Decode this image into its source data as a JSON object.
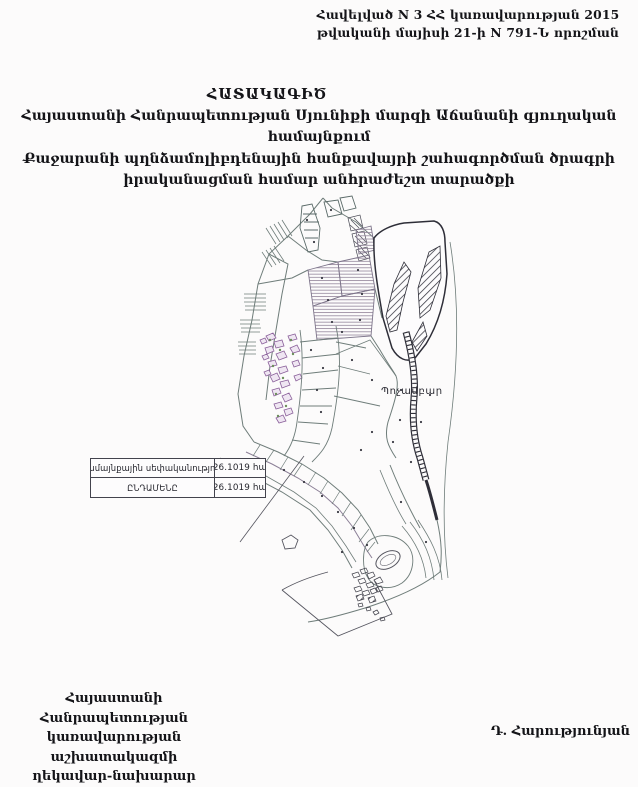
{
  "document": {
    "annex": {
      "line1": "Հավելված N 3",
      "line2": "ՀՀ կառավարության 2015 թվականի",
      "line3": "մայիսի 21-ի N 791-Ն որոշման"
    },
    "title": {
      "line1": "ՀԱՏԱԿԱԳԻԾ",
      "line2": "Հայաստանի Հանրապետության Սյունիքի մարզի Աճանանի գյուղական համայնքում",
      "line3": "Քաջարանի պղնձամոլիբդենային հանքավայրի շահագործման ծրագրի",
      "line4": "իրականացման համար անհրաժեշտ տարածքի"
    },
    "signature": {
      "left_line1": "Հայաստանի Հանրապետության",
      "left_line2": "կառավարության աշխատակազմի",
      "left_line3": "ղեկավար-նախարար",
      "right_name": "Դ. Հարությունյան"
    }
  },
  "map": {
    "area_label": "Պոչամբար",
    "legend_table": {
      "rows": [
        {
          "label": "Համայնքային սեփականություն",
          "value": "26.1019 հա"
        },
        {
          "label": "ԸՆԴԱՄԵՆԸ",
          "value": "26.1019 հա"
        }
      ]
    },
    "colors": {
      "map_line": "#6f7d7a",
      "dark_line": "#2e2e38",
      "parcel_purple": "#8a5f9a",
      "parcel_green": "#6d8f5c",
      "table_border": "#43434d",
      "paper": "#fcfbfb"
    }
  }
}
